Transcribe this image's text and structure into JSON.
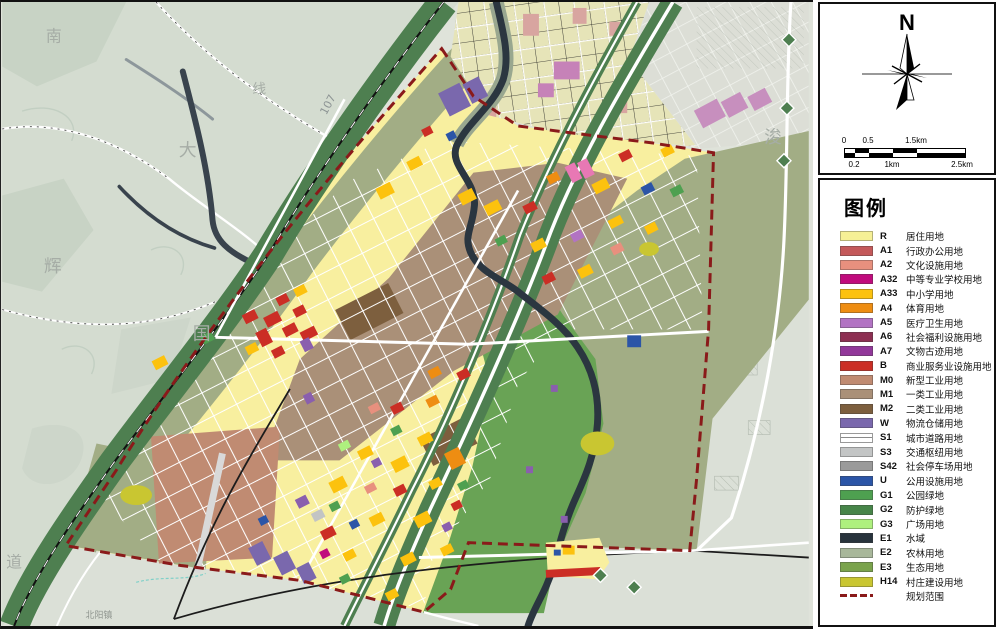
{
  "panel": {
    "compass_label": "N",
    "scale": {
      "top": [
        "0",
        "0.5",
        "1.5km"
      ],
      "bottom": [
        "0.2",
        "1km",
        "2.5km"
      ]
    },
    "legend": {
      "title": "图例",
      "items": [
        {
          "code": "R",
          "label": "居住用地",
          "color": "#f6f096"
        },
        {
          "code": "A1",
          "label": "行政办公用地",
          "color": "#c4595a"
        },
        {
          "code": "A2",
          "label": "文化设施用地",
          "color": "#e8907e"
        },
        {
          "code": "A32",
          "label": "中等专业学校用地",
          "color": "#c00b7d"
        },
        {
          "code": "A33",
          "label": "中小学用地",
          "color": "#fcc20e"
        },
        {
          "code": "A4",
          "label": "体育用地",
          "color": "#ee8d12"
        },
        {
          "code": "A5",
          "label": "医疗卫生用地",
          "color": "#b273c3"
        },
        {
          "code": "A6",
          "label": "社会福利设施用地",
          "color": "#8d2f52"
        },
        {
          "code": "A7",
          "label": "文物古迹用地",
          "color": "#92389a"
        },
        {
          "code": "B",
          "label": "商业服务业设施用地",
          "color": "#cb2e25"
        },
        {
          "code": "M0",
          "label": "新型工业用地",
          "color": "#c08b72"
        },
        {
          "code": "M1",
          "label": "一类工业用地",
          "color": "#aa9078"
        },
        {
          "code": "M2",
          "label": "二类工业用地",
          "color": "#7d5f3e"
        },
        {
          "code": "W",
          "label": "物流仓储用地",
          "color": "#7a68ad"
        },
        {
          "code": "S1",
          "label": "城市道路用地",
          "color": "#ffffff",
          "swatch": "road"
        },
        {
          "code": "S3",
          "label": "交通枢纽用地",
          "color": "#c3c5c5"
        },
        {
          "code": "S42",
          "label": "社会停车场用地",
          "color": "#9a9a9a"
        },
        {
          "code": "U",
          "label": "公用设施用地",
          "color": "#2b55a7"
        },
        {
          "code": "G1",
          "label": "公园绿地",
          "color": "#4ea050"
        },
        {
          "code": "G2",
          "label": "防护绿地",
          "color": "#478549"
        },
        {
          "code": "G3",
          "label": "广场用地",
          "color": "#aef07e"
        },
        {
          "code": "E1",
          "label": "水域",
          "color": "#28333c"
        },
        {
          "code": "E2",
          "label": "农林用地",
          "color": "#a8b79a"
        },
        {
          "code": "E3",
          "label": "生态用地",
          "color": "#7aa34c"
        },
        {
          "code": "H14",
          "label": "村庄建设用地",
          "color": "#c9c631"
        },
        {
          "code": "",
          "label": "规划范围",
          "swatch": "dash"
        }
      ]
    }
  },
  "map": {
    "labels": [
      "南",
      "大",
      "辉",
      "国",
      "道",
      "浚",
      "线",
      "107",
      "北阳镇"
    ],
    "colors": {
      "background": "#dfe3da",
      "terrain": "#d4dcd0",
      "green_corridor": "#4e7f50",
      "farmland": "#a2ad85",
      "park": "#69a355",
      "water": "#2b3640",
      "old_city": "#e6e4b8",
      "boundary": "#8a1a1a"
    }
  }
}
